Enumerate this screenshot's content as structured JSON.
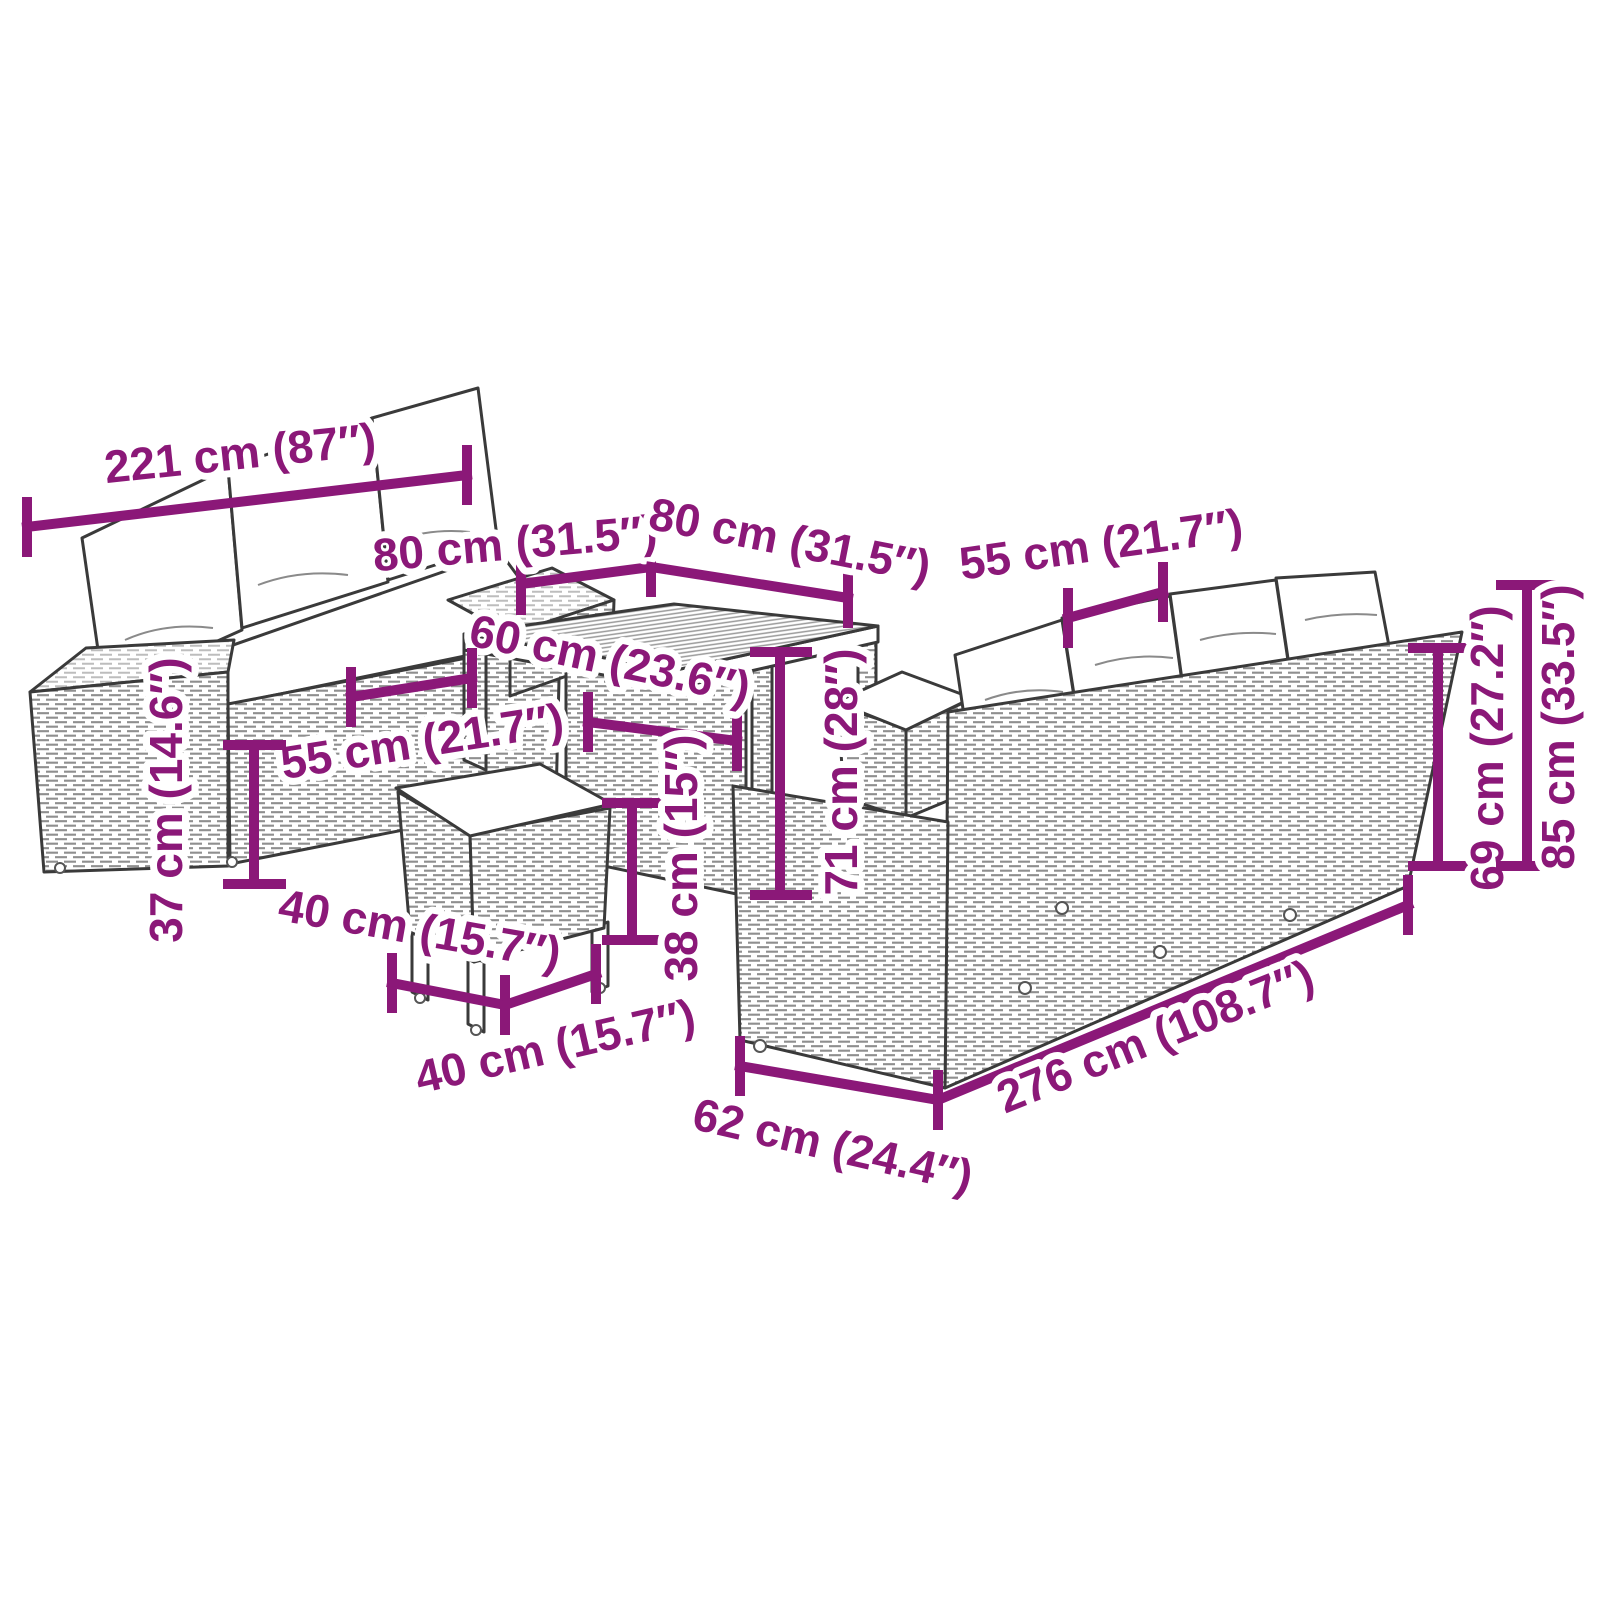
{
  "diagram": {
    "accent_color": "#8B1878",
    "line_art_color": "#3A3A3A",
    "cushion_color": "#FFFFFF",
    "units": [
      "cm",
      "inch"
    ],
    "dimensions": [
      {
        "name": "left-sofa-length",
        "cm": 221,
        "inch": "87",
        "label": "221 cm (87″)"
      },
      {
        "name": "table-top-side-left",
        "cm": 80,
        "inch": "31.5",
        "label": "80 cm (31.5″)"
      },
      {
        "name": "table-top-side-right",
        "cm": 80,
        "inch": "31.5",
        "label": "80 cm (31.5″)"
      },
      {
        "name": "right-sofa-cushion-width",
        "cm": 55,
        "inch": "21.7",
        "label": "55 cm (21.7″)"
      },
      {
        "name": "table-lower-width",
        "cm": 60,
        "inch": "23.6",
        "label": "60 cm (23.6″)"
      },
      {
        "name": "left-sofa-seat-width",
        "cm": 55,
        "inch": "21.7",
        "label": "55 cm (21.7″)"
      },
      {
        "name": "left-sofa-seat-height",
        "cm": 37,
        "inch": "14.6",
        "label": "37 cm (14.6″)"
      },
      {
        "name": "stool-depth",
        "cm": 40,
        "inch": "15.7",
        "label": "40 cm (15.7″)"
      },
      {
        "name": "stool-width",
        "cm": 40,
        "inch": "15.7",
        "label": "40 cm (15.7″)"
      },
      {
        "name": "stool-height",
        "cm": 38,
        "inch": "15",
        "label": "38 cm (15″)"
      },
      {
        "name": "table-height",
        "cm": 71,
        "inch": "28",
        "label": "71 cm (28″)"
      },
      {
        "name": "right-sofa-back-height",
        "cm": 69,
        "inch": "27.2",
        "label": "69 cm (27.2″)"
      },
      {
        "name": "right-sofa-total-height",
        "cm": 85,
        "inch": "33.5",
        "label": "85 cm (33.5″)"
      },
      {
        "name": "right-sofa-length",
        "cm": 276,
        "inch": "108.7",
        "label": "276 cm (108.7″)"
      },
      {
        "name": "right-sofa-depth",
        "cm": 62,
        "inch": "24.4",
        "label": "62 cm (24.4″)"
      }
    ]
  }
}
